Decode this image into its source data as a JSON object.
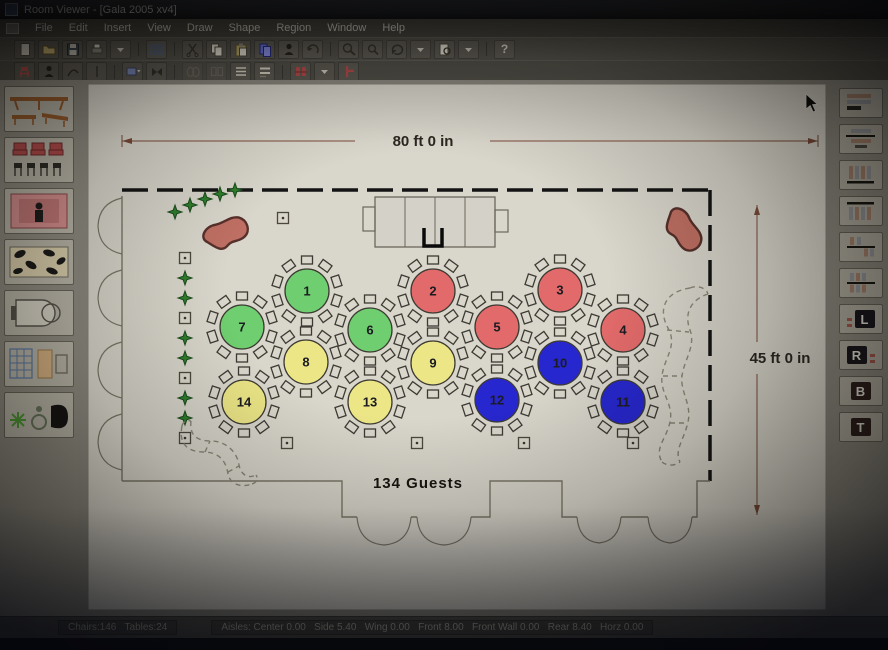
{
  "window_title": "Room Viewer - [Gala 2005 xv4]",
  "menu_items": [
    "File",
    "Edit",
    "Insert",
    "View",
    "Draw",
    "Shape",
    "Region",
    "Window",
    "Help"
  ],
  "toolbar1": {
    "icon_names": [
      "new-icon",
      "open-icon",
      "save-icon",
      "print-icon",
      "dropdown-icon",
      "table-grid-icon",
      "dropdown-icon",
      "cut-icon",
      "copy-icon",
      "paste-icon",
      "paste-special-icon",
      "person-icon",
      "undo-icon",
      "zoom-in-icon",
      "zoom-out-icon",
      "refresh-icon",
      "dropdown-icon",
      "print-preview-icon",
      "dropdown-icon",
      "help-icon"
    ],
    "help_glyph": "?"
  },
  "toolbar2": {
    "icon_names": [
      "red-chair-icon",
      "person-icon",
      "curve-icon",
      "tick-icon",
      "dropdown-icon",
      "blue-table-icon",
      "dropdown-icon",
      "bowtie-icon",
      "ellipse-pair-icon",
      "rect-pair-icon",
      "row-lines-icon",
      "row-lines2-icon",
      "red-chairs-pair-icon",
      "dropdown-icon",
      "red-chair-side-icon"
    ],
    "disabled_icons": [
      "ellipse-pair-icon",
      "rect-pair-icon"
    ]
  },
  "left_palette_items": [
    "head-table",
    "chair-row",
    "stage-podium",
    "dance-floor",
    "grand-piano",
    "table-chair-set",
    "plants-accessories"
  ],
  "right_palette": {
    "item_names": [
      "rows-wide",
      "rows-narrow",
      "columns-baseline",
      "columns-topline",
      "distribute-horizontal",
      "distribute-vertical",
      "align-left",
      "align-right",
      "align-bottom",
      "align-top"
    ],
    "letters": {
      "left": "L",
      "right": "R",
      "bottom": "B",
      "top": "T"
    }
  },
  "floorplan": {
    "width_label": "80 ft  0 in",
    "height_label": "45 ft  0 in",
    "guests_label": "134 Guests",
    "chairs_per_table": 10,
    "table_colors": {
      "green": "#6fce6f",
      "red": "#e26a6a",
      "yellow": "#ece687",
      "blue": "#2727cf"
    },
    "tables": [
      {
        "num": "1",
        "color": "#6fce6f",
        "x": 229,
        "y": 211
      },
      {
        "num": "2",
        "color": "#e26a6a",
        "x": 355,
        "y": 211
      },
      {
        "num": "3",
        "color": "#e26a6a",
        "x": 482,
        "y": 210
      },
      {
        "num": "7",
        "color": "#6fce6f",
        "x": 164,
        "y": 247
      },
      {
        "num": "6",
        "color": "#6fce6f",
        "x": 292,
        "y": 250
      },
      {
        "num": "5",
        "color": "#e26a6a",
        "x": 419,
        "y": 247
      },
      {
        "num": "4",
        "color": "#e26a6a",
        "x": 545,
        "y": 250
      },
      {
        "num": "8",
        "color": "#ece687",
        "x": 228,
        "y": 282
      },
      {
        "num": "9",
        "color": "#ece687",
        "x": 355,
        "y": 283
      },
      {
        "num": "10",
        "color": "#2727cf",
        "x": 482,
        "y": 283
      },
      {
        "num": "14",
        "color": "#ece687",
        "x": 166,
        "y": 322
      },
      {
        "num": "13",
        "color": "#ece687",
        "x": 292,
        "y": 322
      },
      {
        "num": "12",
        "color": "#2727cf",
        "x": 419,
        "y": 320
      },
      {
        "num": "11",
        "color": "#2727cf",
        "x": 545,
        "y": 322
      }
    ]
  },
  "status": {
    "counts": "Chairs:146   Tables:24",
    "aisles": "Aisles: Center 0.00   Side 5.40   Wing 0.00   Front 8.00   Front Wall 0.00   Rear 8.40   Horz 0.00"
  }
}
